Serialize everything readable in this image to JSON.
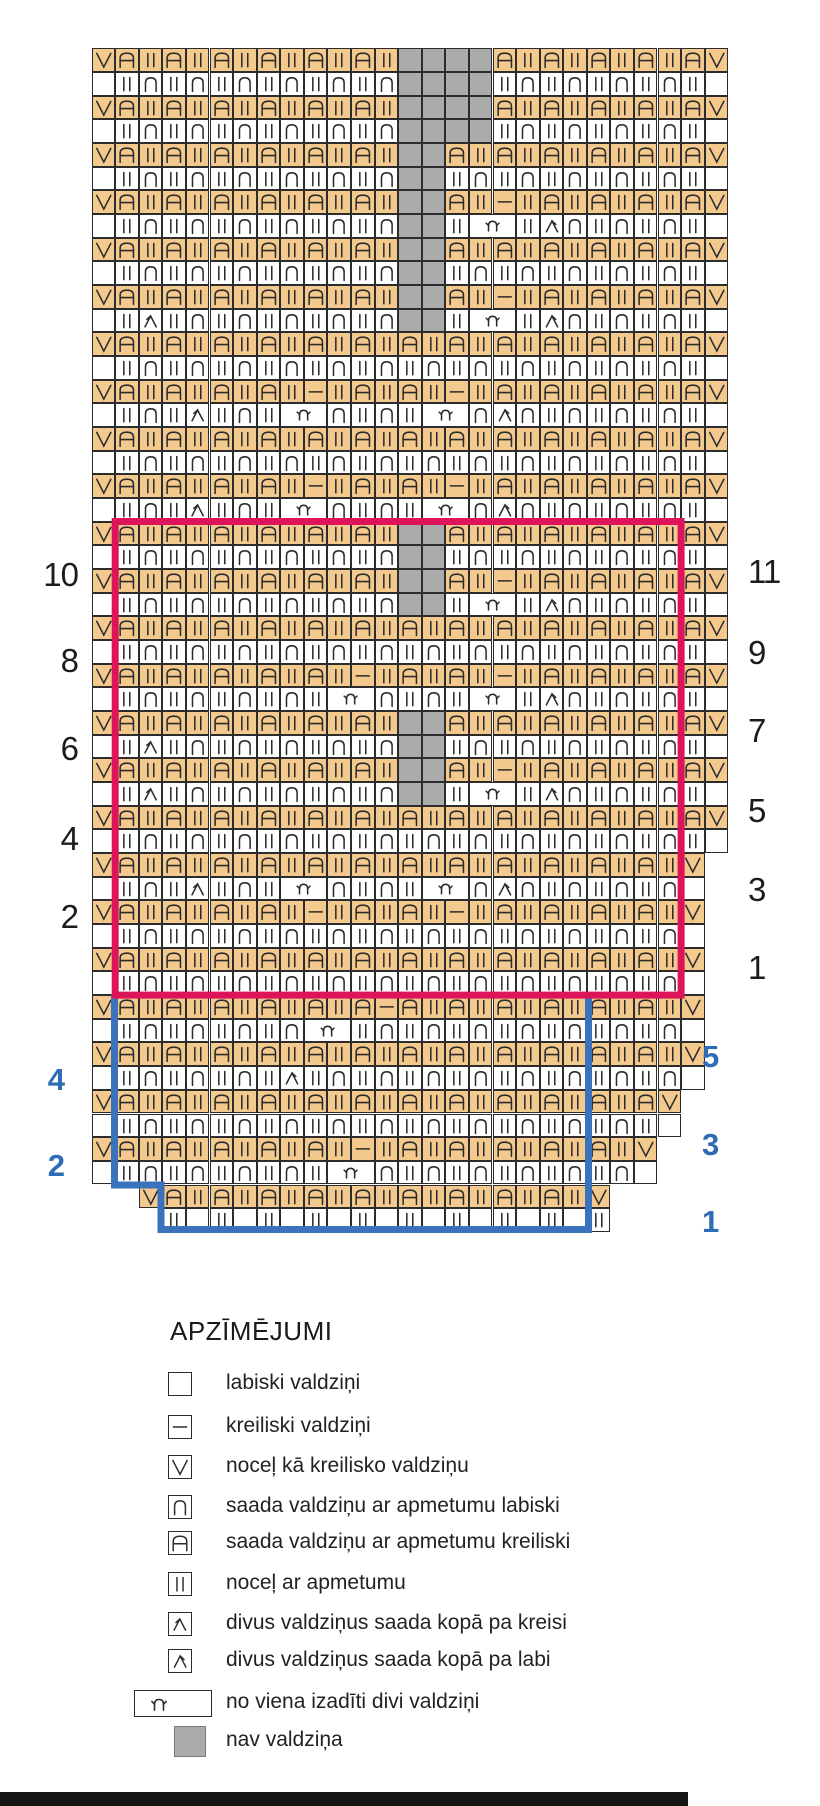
{
  "chart": {
    "origin_x": 91.6,
    "origin_y": 48.3,
    "cell_w": 23.58,
    "cell_h": 23.67,
    "colors": {
      "orange": "#f4c98e",
      "gray": "#ababab",
      "white": "#ffffff",
      "grid_line": "#2c2c2c",
      "repeat_red": "#dd1459",
      "repeat_blue": "#3a73bc"
    },
    "rows": [
      {
        "start": 0,
        "type": "orange",
        "cells": "VA|A|A|A|A|A|GGGGA|A|A|A|AV"
      },
      {
        "start": 0,
        "type": "white",
        "cells": ".|n|n|n|n|n|nGGGG|n|n|n|n|."
      },
      {
        "start": 0,
        "type": "orange",
        "cells": "VA|A|A|A|A|A|GGGGA|A|A|A|AV"
      },
      {
        "start": 0,
        "type": "white",
        "cells": ".|n|n|n|n|n|nGGGG|n|n|n|n|."
      },
      {
        "start": 0,
        "type": "orange",
        "cells": "VA|A|A|A|A|A|GGA|A|A|A|A|AV"
      },
      {
        "start": 0,
        "type": "white",
        "cells": ".|n|n|n|n|n|nGG|n|n|n|n|n|."
      },
      {
        "start": 0,
        "type": "orange",
        "cells": "VA|A|A|A|A|A|GGA|-|A|A|A|AV"
      },
      {
        "start": 0,
        "type": "white",
        "cells": ".|n|n|n|n|n|nGG|Yy|Rn|n|n|."
      },
      {
        "start": 0,
        "type": "orange",
        "cells": "VA|A|A|A|A|A|GGA|A|A|A|A|AV"
      },
      {
        "start": 0,
        "type": "white",
        "cells": ".|n|n|n|n|n|nGG|n|n|n|n|n|."
      },
      {
        "start": 0,
        "type": "orange",
        "cells": "VA|A|A|A|A|A|GGA|-|A|A|A|AV"
      },
      {
        "start": 0,
        "type": "white",
        "cells": ".|L|n|n|n|n|nGG|Yy|Rn|n|n|."
      },
      {
        "start": 0,
        "type": "orange",
        "cells": "VA|A|A|A|A|A|A|A|A|A|A|A|AV"
      },
      {
        "start": 0,
        "type": "white",
        "cells": ".|n|n|n|n|n|n|n|n|n|n|n|n|."
      },
      {
        "start": 0,
        "type": "orange",
        "cells": "VA|A|A|A|-|A|A|-|A|A|A|A|AV"
      },
      {
        "start": 0,
        "type": "white",
        "cells": ".|n|L|n|Yyn|n|YynRn|n|n|n|."
      },
      {
        "start": 0,
        "type": "orange",
        "cells": "VA|A|A|A|A|A|A|A|A|A|A|A|AV"
      },
      {
        "start": 0,
        "type": "white",
        "cells": ".|n|n|n|n|n|n|n|n|n|n|n|n|."
      },
      {
        "start": 0,
        "type": "orange",
        "cells": "VA|A|A|A|-|A|A|-|A|A|A|A|AV"
      },
      {
        "start": 0,
        "type": "white",
        "cells": ".|n|L|n|Yyn|n|YynRn|n|n|n|."
      },
      {
        "start": 0,
        "type": "orange",
        "cells": "VA|A|A|A|A|A|GGA|A|A|A|A|AV"
      },
      {
        "start": 0,
        "type": "white",
        "cells": ".|n|n|n|n|n|nGG|n|n|n|n|n|."
      },
      {
        "start": 0,
        "type": "orange",
        "cells": "VA|A|A|A|A|A|GGA|-|A|A|A|AV"
      },
      {
        "start": 0,
        "type": "white",
        "cells": ".|n|n|n|n|n|nGG|Yy|Rn|n|n|."
      },
      {
        "start": 0,
        "type": "orange",
        "cells": "VA|A|A|A|A|A|A|A|A|A|A|A|AV"
      },
      {
        "start": 0,
        "type": "white",
        "cells": ".|n|n|n|n|n|n|n|n|n|n|n|n|."
      },
      {
        "start": 0,
        "type": "orange",
        "cells": "VA|A|A|A|A|-|A|A|-|A|A|A|AV"
      },
      {
        "start": 0,
        "type": "white",
        "cells": ".|n|n|n|n|Yyn|n|Yy|Rn|n|n|."
      },
      {
        "start": 0,
        "type": "orange",
        "cells": "VA|A|A|A|A|A|GGA|A|A|A|A|AV"
      },
      {
        "start": 0,
        "type": "white",
        "cells": ".|L|n|n|n|n|nGG|n|n|n|n|n|."
      },
      {
        "start": 0,
        "type": "orange",
        "cells": "VA|A|A|A|A|A|GGA|-|A|A|A|AV"
      },
      {
        "start": 0,
        "type": "white",
        "cells": ".|L|n|n|n|n|nGG|Yy|Rn|n|n|."
      },
      {
        "start": 0,
        "type": "orange",
        "cells": "VA|A|A|A|A|A|A|A|A|A|A|A|AV"
      },
      {
        "start": 0,
        "type": "white",
        "cells": ".|n|n|n|n|n|n|n|n|n|n|n|n|."
      },
      {
        "start": 0,
        "type": "orange",
        "cells": "VA|A|A|A|A|A|A|A|A|A|A|A|V"
      },
      {
        "start": 0,
        "type": "white",
        "cells": ".|n|L|n|Yyn|n|YynRn|n|n|n."
      },
      {
        "start": 0,
        "type": "orange",
        "cells": "VA|A|A|A|-|A|A|-|A|A|A|A|V"
      },
      {
        "start": 0,
        "type": "white",
        "cells": ".|n|n|n|n|n|n|n|n|n|n|n|n."
      },
      {
        "start": 0,
        "type": "orange",
        "cells": "VA|A|A|A|A|A|A|A|A|A|A|A|V"
      },
      {
        "start": 0,
        "type": "white",
        "cells": ".|n|n|n|n|n|n|n|n|n|n|n|n."
      },
      {
        "start": 0,
        "type": "orange",
        "cells": "VA|A|A|A|A|A-A|A|A|A|A|A|V"
      },
      {
        "start": 0,
        "type": "white",
        "cells": ".|n|n|n|nYy|n|n|n|n|n|n|n."
      },
      {
        "start": 0,
        "type": "orange",
        "cells": "VA|A|A|A|A|A|A|A|A|A|A|A|V"
      },
      {
        "start": 0,
        "type": "white",
        "cells": ".|n|n|n|R|n|n|n|n|n|n|n|n."
      },
      {
        "start": 0,
        "type": "orange",
        "cells": "VA|A|A|A|A|A|A|A|A|A|A|AV"
      },
      {
        "start": 0,
        "type": "white",
        "cells": ".|n|n|n|n|n|n|n|n|n|n|n|."
      },
      {
        "start": 0,
        "type": "orange",
        "cells": "VA|A|A|A|A|-|A|A|A|A|A|V"
      },
      {
        "start": 0,
        "type": "white",
        "cells": ".|n|n|n|n|Yyn|n|n|n|n|n."
      },
      {
        "start": 2,
        "type": "orange",
        "cells": "VA|A|A|A|A|A|A|A|A|V"
      },
      {
        "start": 3,
        "type": "white",
        "cells": "|.|.|.|.|.|.|.|.|.|"
      }
    ],
    "repeat_boxes": {
      "red": {
        "x1": 115.2,
        "y1": 521.5,
        "x2": 681.1,
        "y2": 995.1
      },
      "blue_path_points": "114.5,995 114.5,1185 161,1185 161,1229.5 588.5,1229.5 588.5,995"
    },
    "row_numbers": {
      "black_left": [
        {
          "t": "10",
          "y": 575
        },
        {
          "t": "8",
          "y": 661
        },
        {
          "t": "6",
          "y": 749
        },
        {
          "t": "4",
          "y": 839
        },
        {
          "t": "2",
          "y": 917
        }
      ],
      "black_right": [
        {
          "t": "11",
          "y": 572
        },
        {
          "t": "9",
          "y": 653
        },
        {
          "t": "7",
          "y": 731
        },
        {
          "t": "5",
          "y": 811
        },
        {
          "t": "3",
          "y": 890
        },
        {
          "t": "1",
          "y": 968
        }
      ],
      "blue_left": [
        {
          "t": "4",
          "y": 1080
        },
        {
          "t": "2",
          "y": 1166
        }
      ],
      "blue_right": [
        {
          "t": "5",
          "y": 1057
        },
        {
          "t": "3",
          "y": 1145
        },
        {
          "t": "1",
          "y": 1222
        }
      ]
    }
  },
  "legend": {
    "title": "APZĪMĒJUMI",
    "items": [
      {
        "symbol": "empty",
        "label": "labiski valdziņi",
        "y": 1385
      },
      {
        "symbol": "dash",
        "label": "kreiliski valdziņi",
        "y": 1428
      },
      {
        "symbol": "V",
        "label": "noceļ kā kreilisko valdziņu",
        "y": 1468
      },
      {
        "symbol": "n",
        "label": "saada valdziņu ar apmetumu labiski",
        "y": 1508
      },
      {
        "symbol": "A",
        "label": "saada valdziņu ar apmetumu kreiliski",
        "y": 1544
      },
      {
        "symbol": "bars",
        "label": "noceļ ar apmetumu",
        "y": 1585
      },
      {
        "symbol": "L",
        "label": "divus valdziņus saada kopā pa kreisi",
        "y": 1625
      },
      {
        "symbol": "R",
        "label": "divus valdziņus saada kopā pa labi",
        "y": 1662
      },
      {
        "symbol": "crown",
        "label": "no viena izadīti divi valdziņi",
        "y": 1704
      },
      {
        "symbol": "gray",
        "label": "nav valdziņa",
        "y": 1742
      }
    ]
  },
  "footer_bar": {
    "x": 0,
    "y": 1792,
    "w": 688,
    "h": 14
  }
}
